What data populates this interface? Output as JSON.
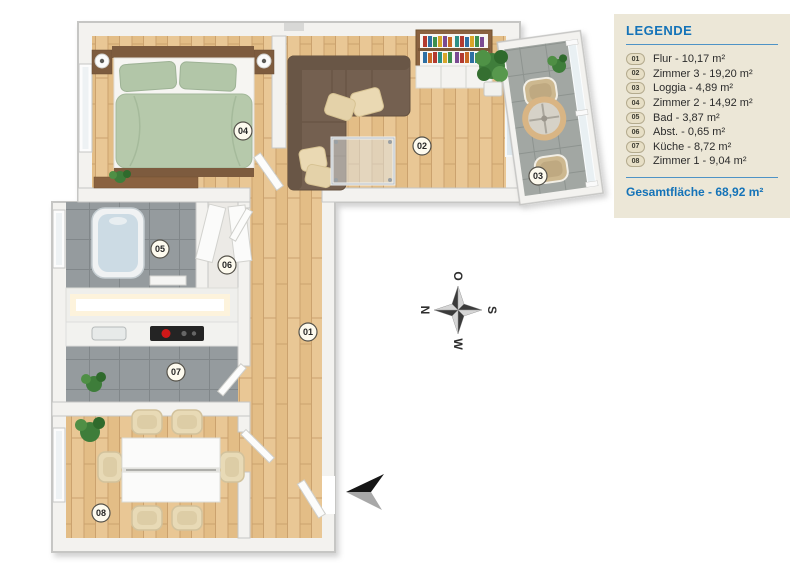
{
  "legend": {
    "title": "LEGENDE",
    "total_label": "Gesamtfläche - 68,92 m²"
  },
  "rooms": [
    {
      "id": "01",
      "name": "Flur",
      "area": "10,17 m²",
      "label": "Flur - 10,17 m²"
    },
    {
      "id": "02",
      "name": "Zimmer 3",
      "area": "19,20 m²",
      "label": "Zimmer 3 - 19,20 m²"
    },
    {
      "id": "03",
      "name": "Loggia",
      "area": "4,89 m²",
      "label": "Loggia - 4,89 m²"
    },
    {
      "id": "04",
      "name": "Zimmer 2",
      "area": "14,92 m²",
      "label": "Zimmer 2 - 14,92 m²"
    },
    {
      "id": "05",
      "name": "Bad",
      "area": "3,87 m²",
      "label": "Bad - 3,87 m²"
    },
    {
      "id": "06",
      "name": "Abst.",
      "area": "0,65 m²",
      "label": "Abst. - 0,65 m²"
    },
    {
      "id": "07",
      "name": "Küche",
      "area": "8,72 m²",
      "label": "Küche - 8,72 m²"
    },
    {
      "id": "08",
      "name": "Zimmer 1",
      "area": "9,04 m²",
      "label": "Zimmer 1 - 9,04 m²"
    }
  ],
  "compass": {
    "north": "N",
    "east": "O",
    "south": "S",
    "west": "W"
  },
  "colors": {
    "accent_blue": "#1473b8",
    "legend_bg": "#ece7d7",
    "wood_floor": "#e6c18c",
    "tile_floor": "#959b9e",
    "wall": "#f3f2ef",
    "sofa_brown": "#746050",
    "bed_green": "#b6c9ab"
  }
}
